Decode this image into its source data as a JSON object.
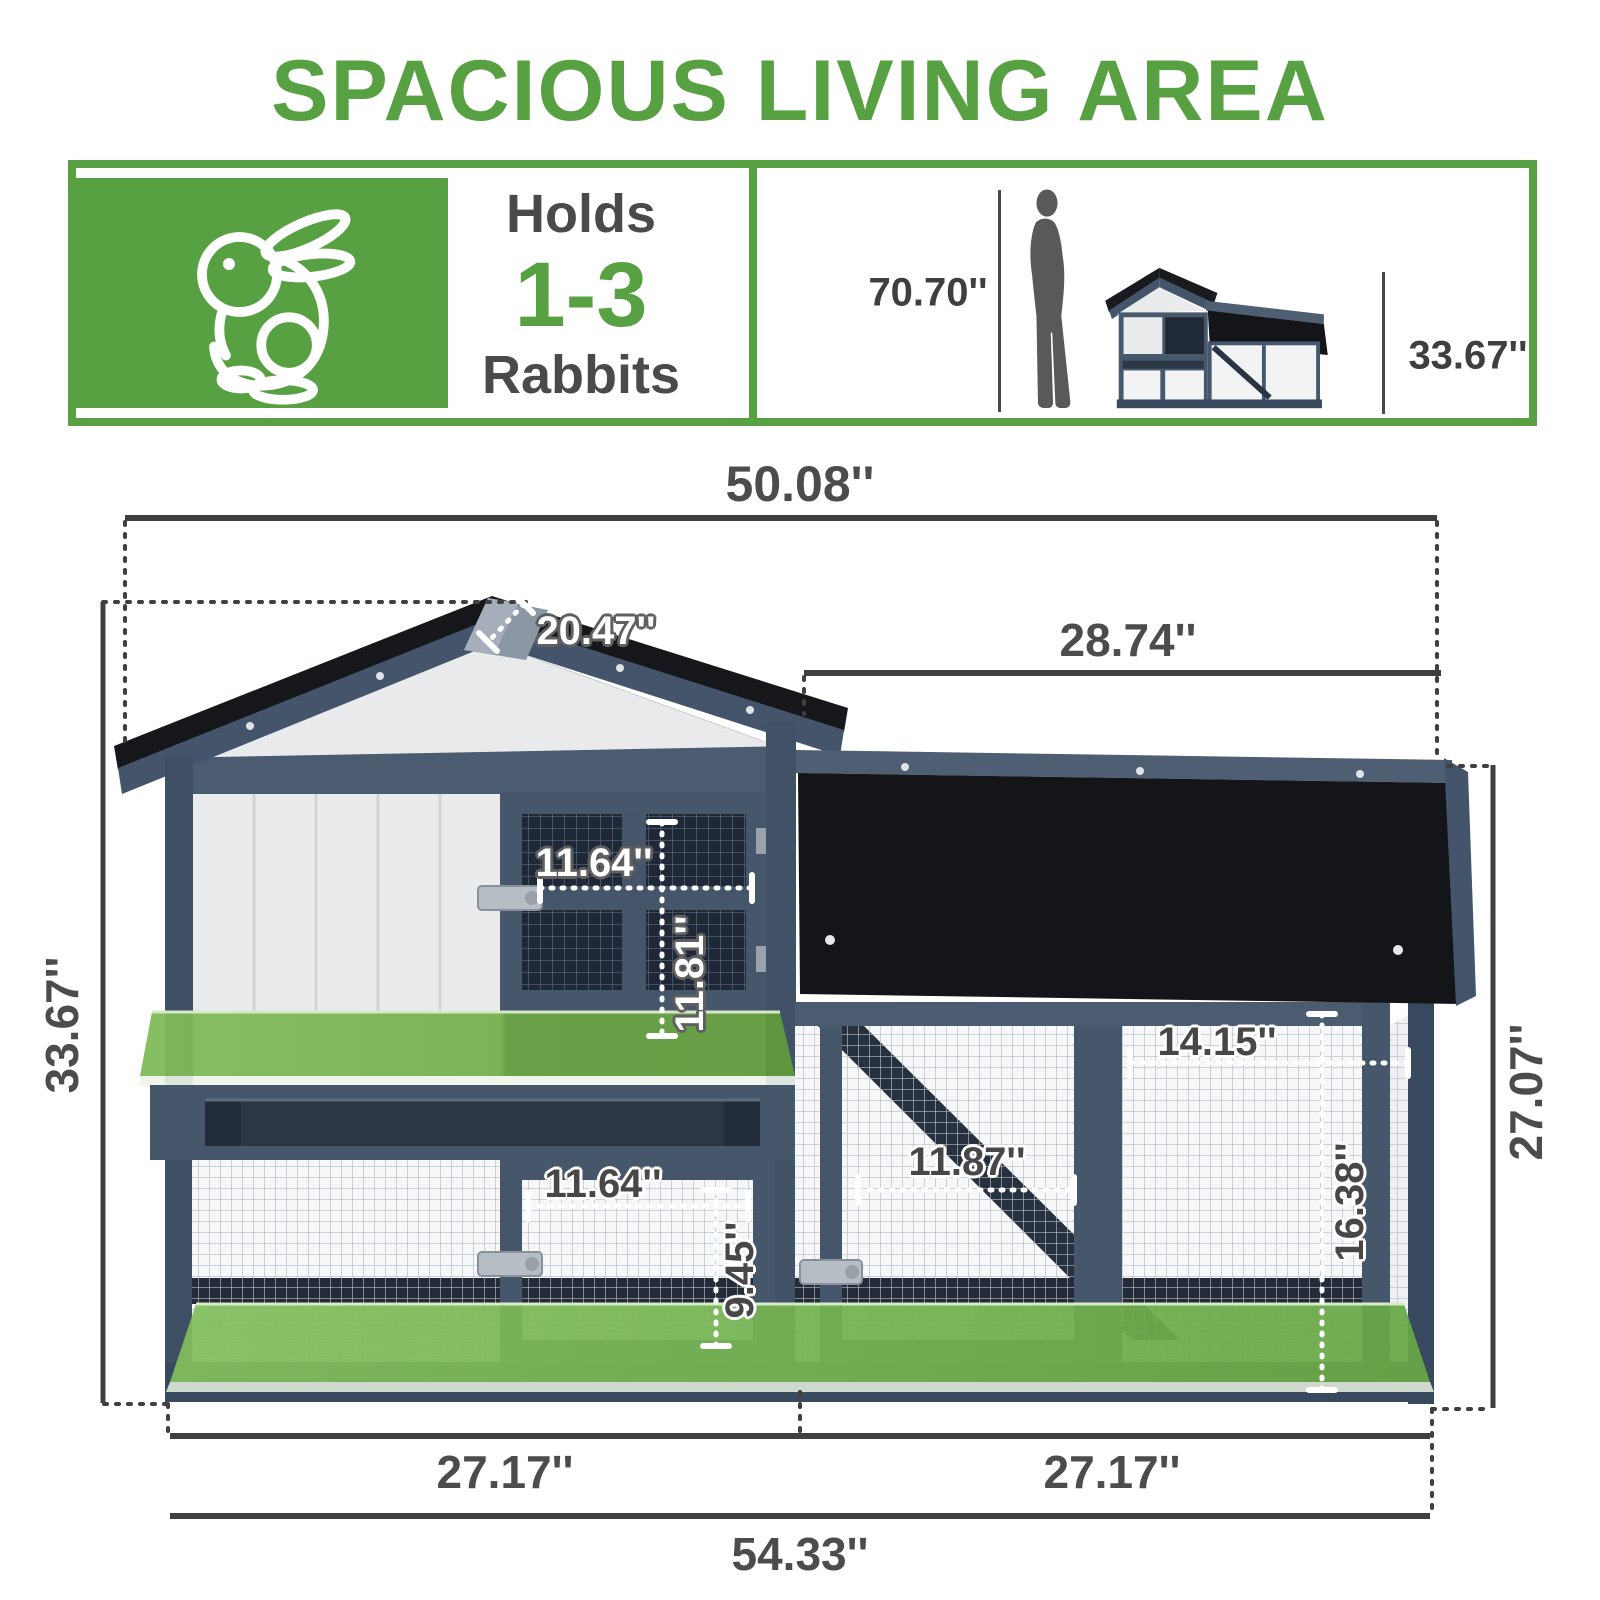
{
  "title": "SPACIOUS LIVING AREA",
  "banner": {
    "holds_label": "Holds",
    "capacity": "1-3",
    "capacity_unit": "Rabbits",
    "person_height": "70.70''",
    "scale_hutch_height": "33.67''"
  },
  "dimensions": {
    "top_width": "50.08''",
    "roof_depth": "20.47''",
    "run_top_width": "28.74''",
    "left_height": "33.67''",
    "right_height": "27.07''",
    "upper_door_width": "11.64''",
    "upper_door_height": "11.81''",
    "run_inner_width": "14.15''",
    "run_door_width": "11.87''",
    "run_inner_height": "16.38''",
    "lower_door_width": "11.64''",
    "lower_door_height": "9.45''",
    "bottom_left_width": "27.17''",
    "bottom_right_width": "27.17''",
    "total_width": "54.33''"
  },
  "colors": {
    "accent_green": "#58a142",
    "frame_slate": "#46566b",
    "roof_black": "#17181b",
    "floor_green": "#6fae4b",
    "dim_text": "#4c4c4c"
  },
  "icons": {
    "rabbit": "rabbit-outline-icon",
    "person": "person-silhouette-icon",
    "hutch": "hutch-thumbnail-icon"
  }
}
